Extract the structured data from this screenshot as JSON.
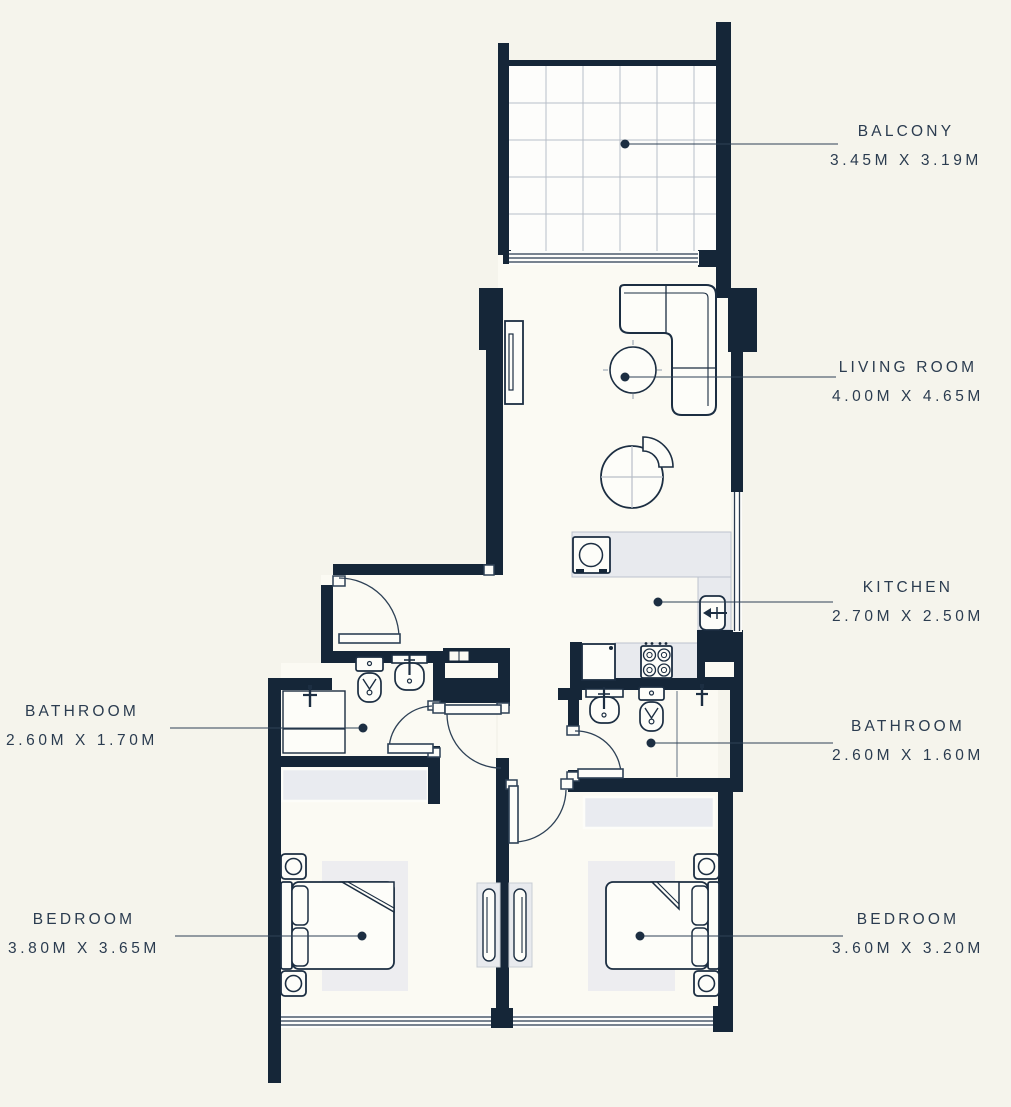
{
  "plan_title": "Two Bedroom Apartment Floor Plan",
  "rooms": [
    {
      "id": "balcony",
      "name": "BALCONY",
      "dims": "3.45M X 3.19M"
    },
    {
      "id": "living-room",
      "name": "LIVING ROOM",
      "dims": "4.00M X 4.65M"
    },
    {
      "id": "kitchen",
      "name": "KITCHEN",
      "dims": "2.70M X 2.50M"
    },
    {
      "id": "bathroom-right",
      "name": "BATHROOM",
      "dims": "2.60M X 1.60M"
    },
    {
      "id": "bathroom-left",
      "name": "BATHROOM",
      "dims": "2.60M X 1.70M"
    },
    {
      "id": "bedroom-left",
      "name": "BEDROOM",
      "dims": "3.80M X 3.65M"
    },
    {
      "id": "bedroom-right",
      "name": "BEDROOM",
      "dims": "3.60M X 3.20M"
    }
  ],
  "colors": {
    "wall": "#152638",
    "background": "#f5f4ec",
    "floor": "#fbfaf3",
    "counter": "#e8eaee",
    "rug": "#ededf0",
    "text": "#2b3c50",
    "leader": "#2e4156"
  }
}
